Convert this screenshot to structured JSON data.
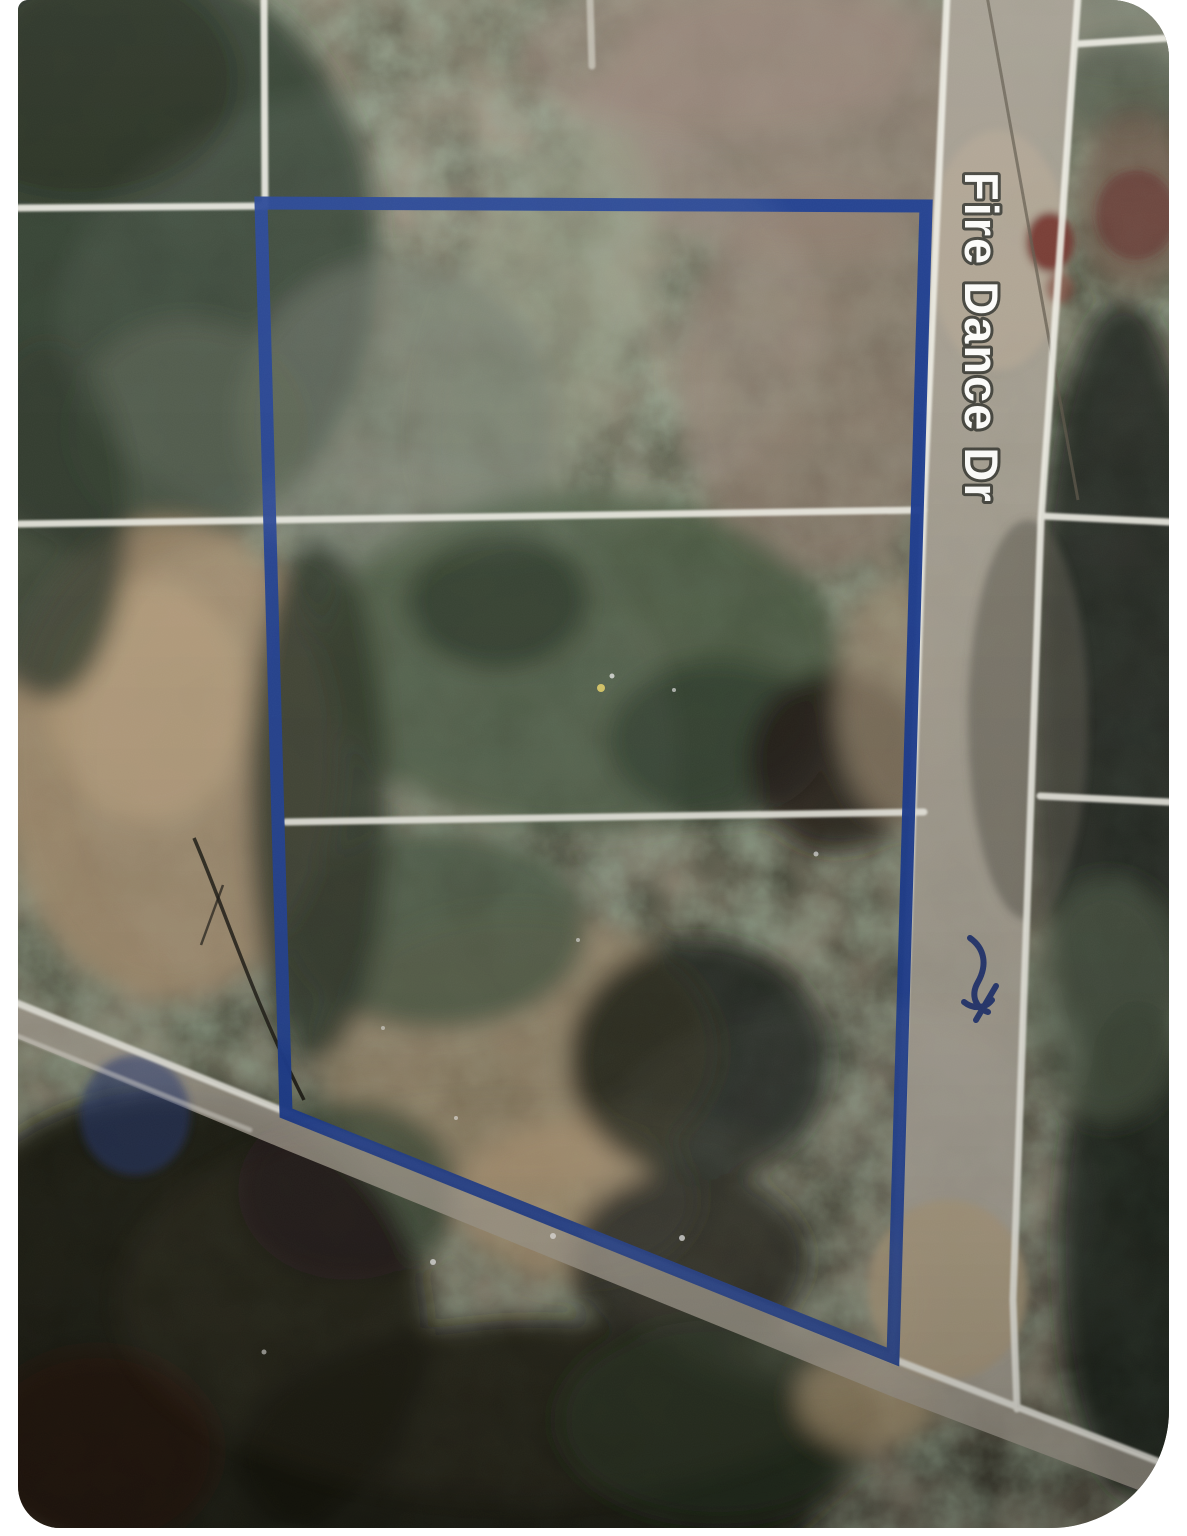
{
  "page": {
    "background_color": "#ffffff",
    "description": "satellite map photo with parcel highlight"
  },
  "map": {
    "view_type": "satellite",
    "street_label": "Fire Dance Dr",
    "street_label_color": "#fbfbf9",
    "street_label_outline_color": "#45453e",
    "parcel_outline_color": "#1e3d8f",
    "gridline_color": "#edece3",
    "road_fill_color": "#a69f92",
    "annotation_scribble_color": "#1c2f6e"
  }
}
